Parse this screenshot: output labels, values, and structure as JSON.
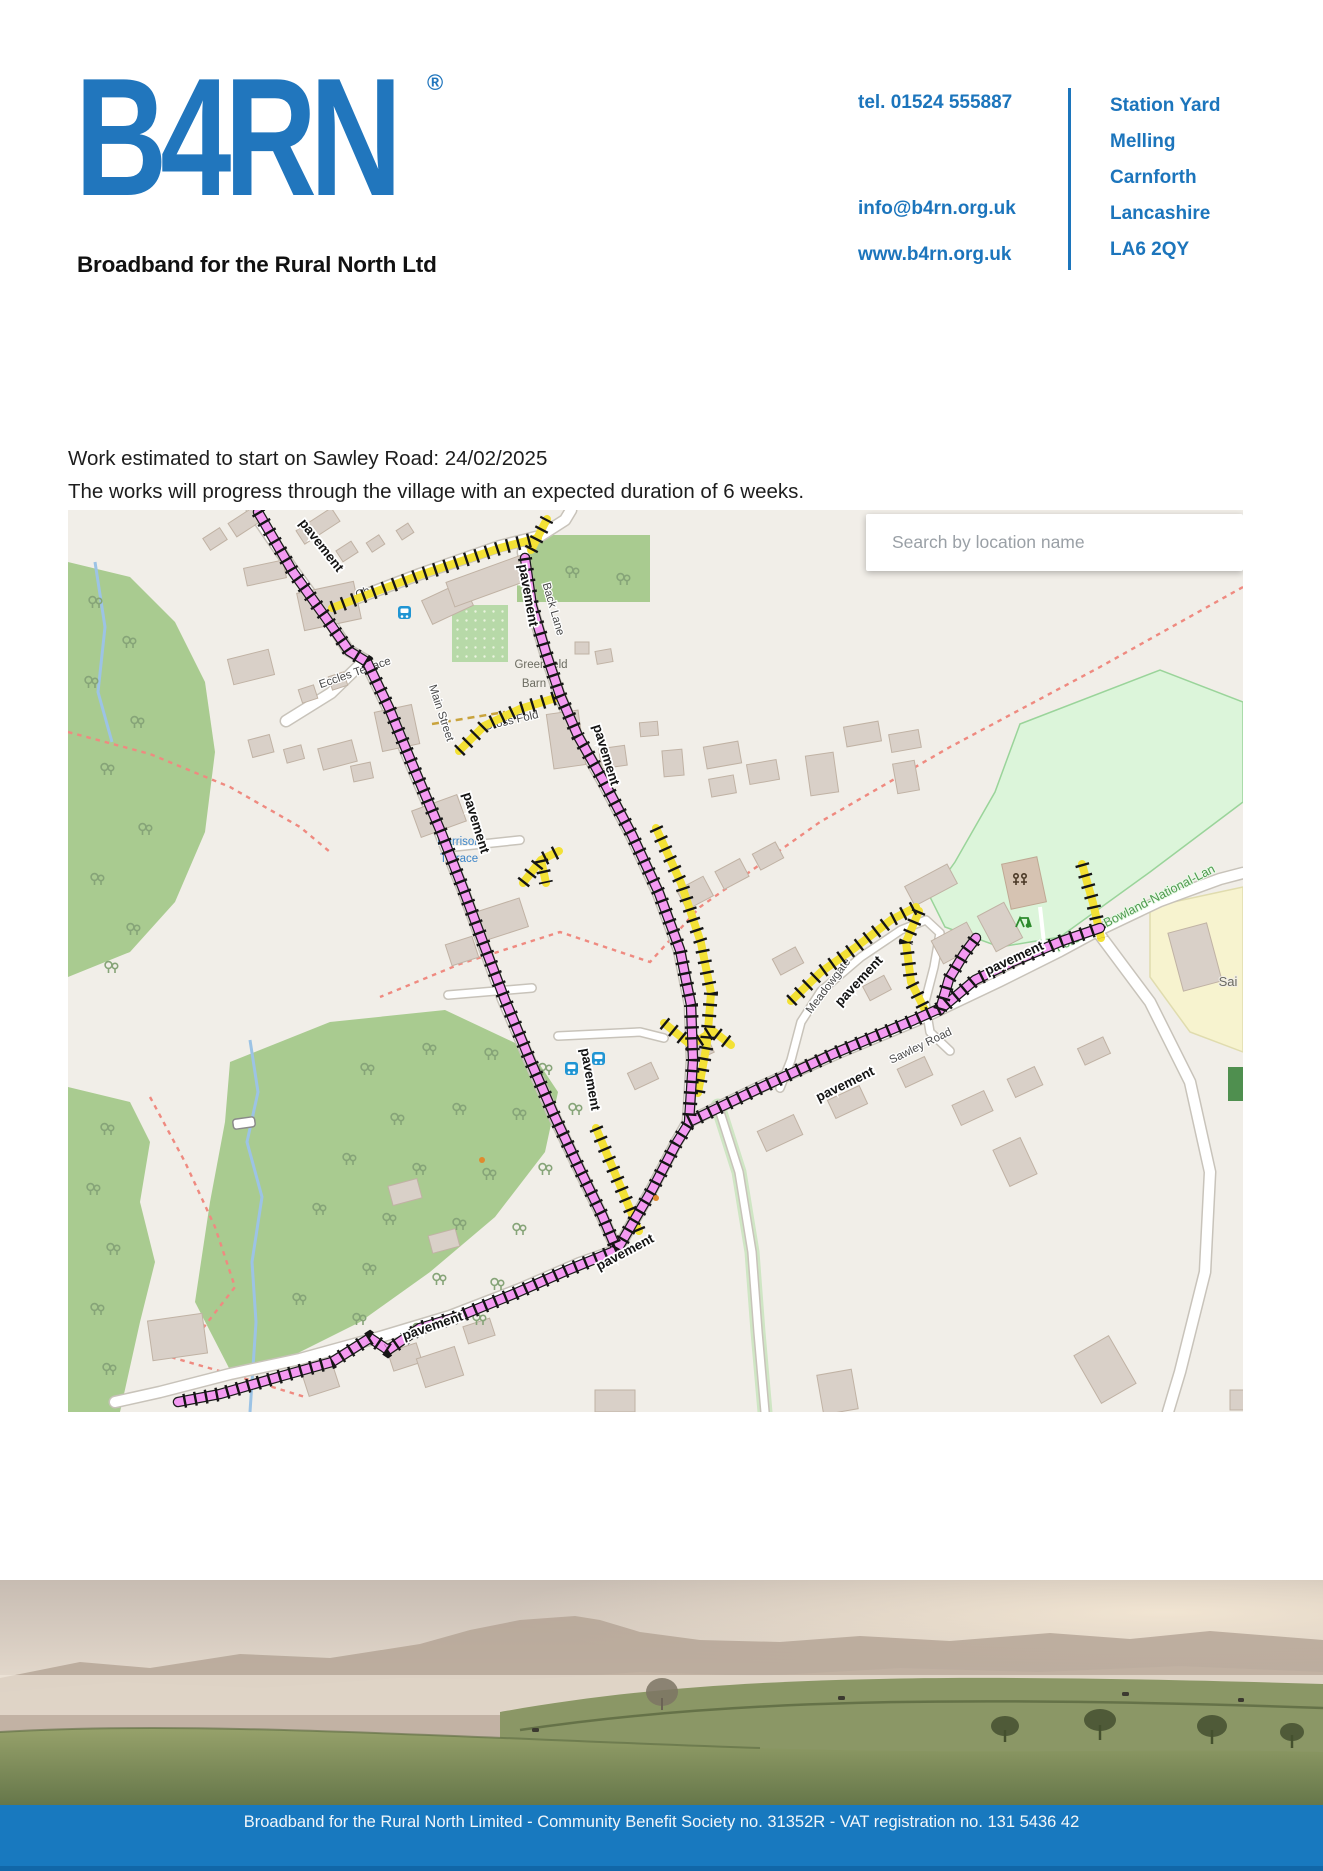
{
  "header": {
    "logo_text": "B4RN",
    "logo_reg": "®",
    "logo_tagline": "Broadband for the Rural North Ltd",
    "contact": {
      "tel": "tel. 01524 555887",
      "email": "info@b4rn.org.uk",
      "web": "www.b4rn.org.uk"
    },
    "address": {
      "line1": "Station Yard",
      "line2": "Melling",
      "line3": "Carnforth",
      "line4": "Lancashire",
      "line5": "LA6 2QY"
    },
    "brand_color": "#1c75bc"
  },
  "body": {
    "line1": "Work estimated to start on Sawley Road: 24/02/2025",
    "line2": "The works will progress through the village with an expected duration of 6 weeks."
  },
  "map": {
    "search_placeholder": "Search by location name",
    "pavement_label": "pavement",
    "streets": {
      "partial_ch": "Ch",
      "back_lane": "Back Lane",
      "cross_fold": "Cross Fold",
      "eccles_terrace": "Eccles Terrace",
      "main_street": "Main Street",
      "meadowgate": "Meadowgate",
      "sawley_road": "Sawley Road"
    },
    "places": {
      "greenfield_line1": "Greenfield",
      "greenfield_line2": "Barn",
      "harrison_line1": "Harrison",
      "harrison_line2": "Terrace",
      "bowland": "Forest-of-Bowland-National-Lan",
      "sai": "Sai"
    },
    "colors": {
      "pavement_pink": "#f49af2",
      "pavement_yellow": "#f3e135",
      "wood_green": "#a9cb90",
      "park_green": "#dcf5da"
    }
  },
  "footer": {
    "text": "Broadband for the Rural North Limited - Community Benefit Society no. 31352R - VAT registration no. 131 5436 42"
  }
}
